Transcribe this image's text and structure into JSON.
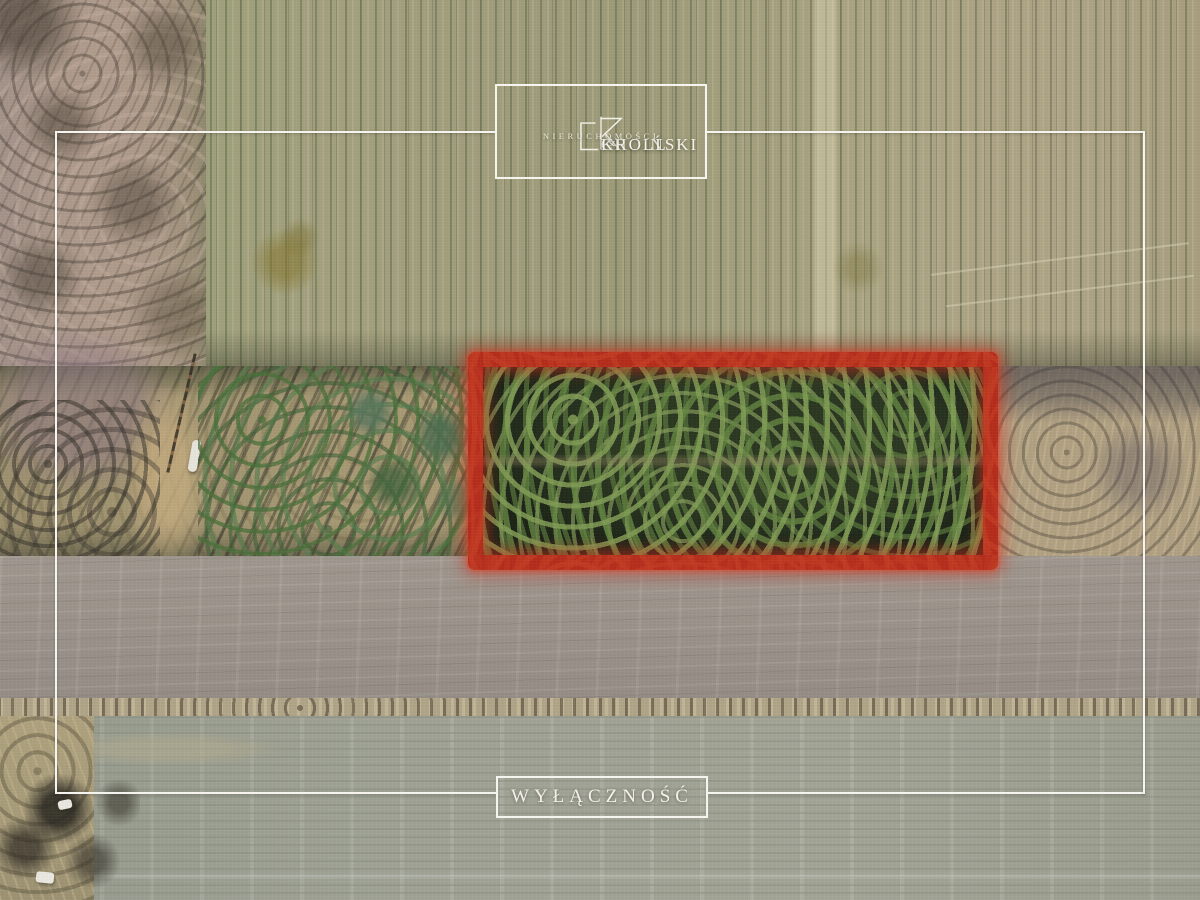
{
  "branding": {
    "monogram": "CK",
    "name_left": "CHOIŃSKI",
    "ampersand": "&",
    "name_right": "KROLL",
    "subtitle": "NIERUCHOMOŚCI"
  },
  "badge": {
    "label": "WYŁĄCZNOŚĆ"
  },
  "icons": {
    "monogram": "ck-monogram-icon"
  },
  "colors": {
    "plot_highlight_red": "#cd2f1d",
    "frame_white": "#f6f4ef",
    "forest_dark": "#1c2417",
    "field_top_olive": "#a3a07e",
    "plowed_grey": "#a09890",
    "bottom_field_green_grey": "#a6a99b"
  }
}
